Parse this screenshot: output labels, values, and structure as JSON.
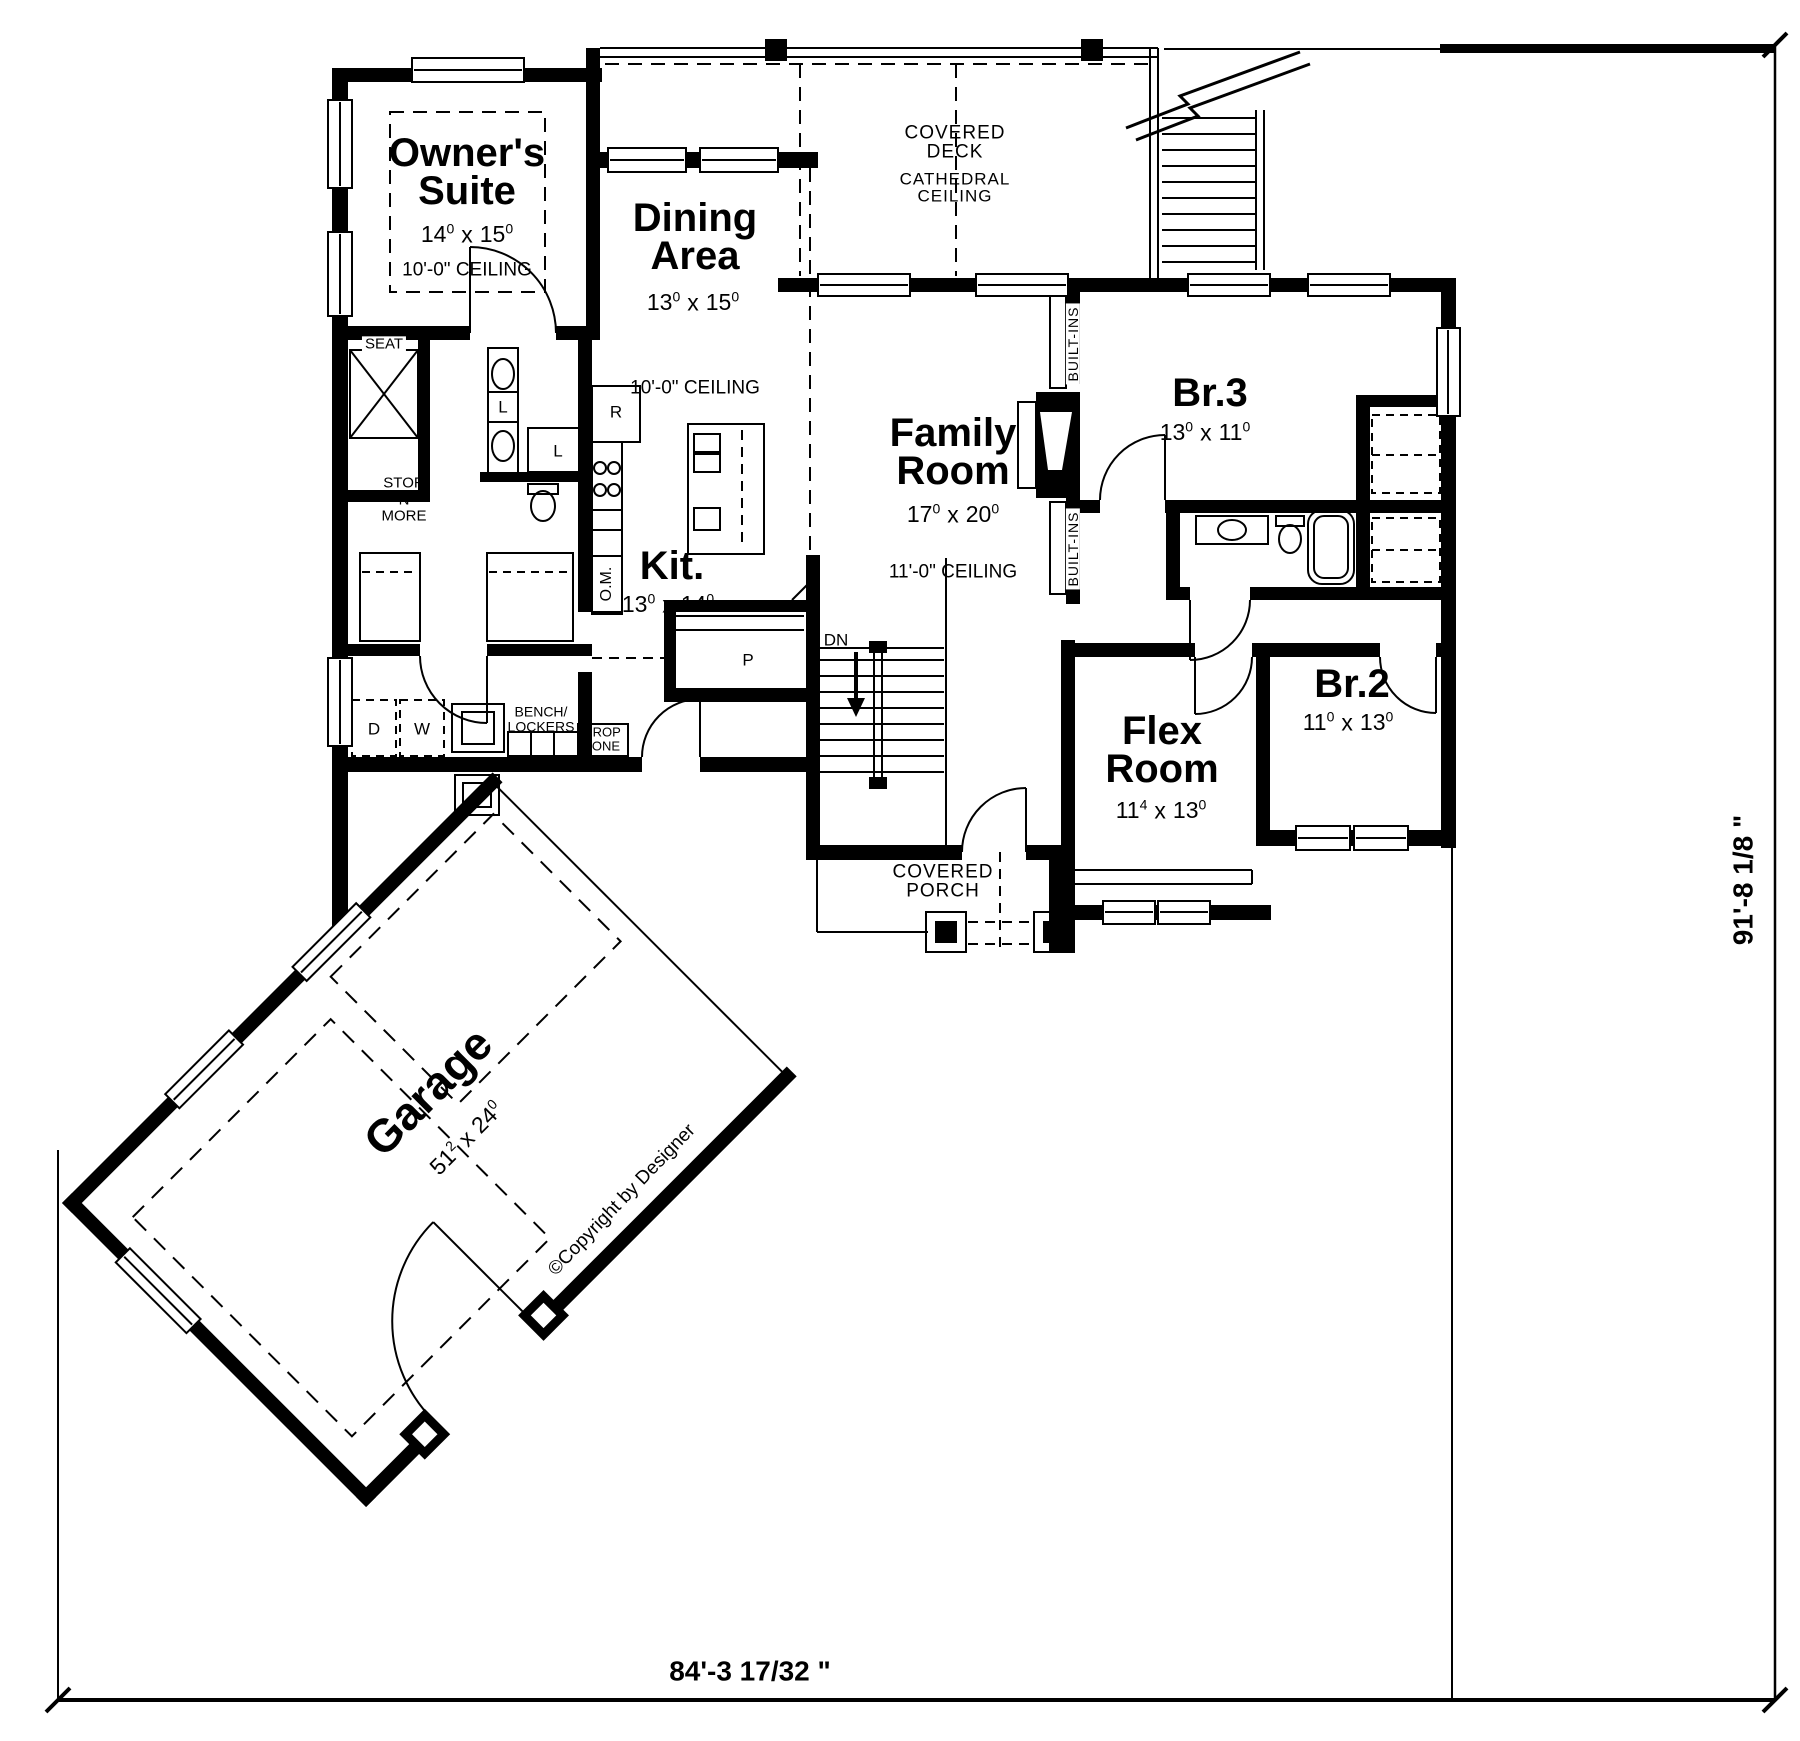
{
  "dimensions": {
    "bottom_label": "84'-3 17/32 \"",
    "right_label": "91'-8 1/8 \""
  },
  "rooms": {
    "owners_suite": {
      "name_line1": "Owner's",
      "name_line2": "Suite",
      "dim": {
        "w": "14",
        "wi": "0",
        "sep": "x",
        "h": "15",
        "hi": "0"
      },
      "ceiling": "10'-0\" CEILING"
    },
    "dining": {
      "name_line1": "Dining",
      "name_line2": "Area",
      "dim": {
        "w": "13",
        "wi": "0",
        "sep": "x",
        "h": "15",
        "hi": "0"
      },
      "ceiling": "10'-0\" CEILING"
    },
    "kitchen": {
      "name": "Kit.",
      "dim": {
        "w": "13",
        "wi": "0",
        "sep": "x",
        "h": "14",
        "hi": "0"
      }
    },
    "family": {
      "name_line1": "Family",
      "name_line2": "Room",
      "dim": {
        "w": "17",
        "wi": "0",
        "sep": "x",
        "h": "20",
        "hi": "0"
      },
      "ceiling": "11'-0\" CEILING"
    },
    "deck": {
      "name_line1": "COVERED",
      "name_line2": "DECK",
      "ceiling_line1": "CATHEDRAL",
      "ceiling_line2": "CEILING"
    },
    "br3": {
      "name": "Br.3",
      "dim": {
        "w": "13",
        "wi": "0",
        "sep": "x",
        "h": "11",
        "hi": "0"
      }
    },
    "br2": {
      "name": "Br.2",
      "dim": {
        "w": "11",
        "wi": "0",
        "sep": "x",
        "h": "13",
        "hi": "0"
      }
    },
    "flex": {
      "name_line1": "Flex",
      "name_line2": "Room",
      "dim": {
        "w": "11",
        "wi": "4",
        "sep": "x",
        "h": "13",
        "hi": "0"
      }
    },
    "porch": {
      "name_line1": "COVERED",
      "name_line2": "PORCH"
    },
    "garage": {
      "name": "Garage",
      "dim": {
        "w": "51",
        "wi": "2",
        "sep": "x",
        "h": "24",
        "hi": "0"
      }
    }
  },
  "labels": {
    "seat": "SEAT",
    "stor1": "STOR",
    "stor2": "-N-",
    "stor3": "MORE",
    "linen": "L",
    "fridge": "R",
    "oven_micro": "O.M.",
    "pantry": "P",
    "stairs_down": "DN",
    "dryer": "D",
    "washer": "W",
    "bench1": "BENCH/",
    "bench2": "LOCKERS",
    "drop1": "DROP",
    "drop2": "ZONE",
    "builtins": "BUILT-INS",
    "copyright": "©Copyright by Designer"
  },
  "colors": {
    "ink": "#000000",
    "paper": "#ffffff"
  }
}
